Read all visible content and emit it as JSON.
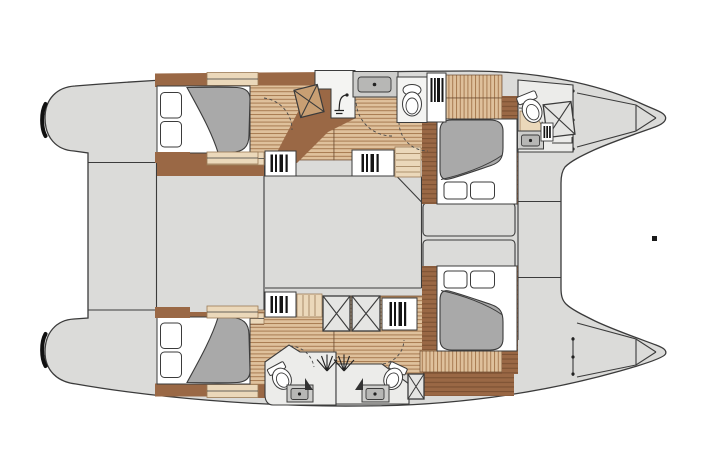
{
  "diagram": {
    "title": "Catamaran interior layout — overhead accommodation plan",
    "type": "boat-floorplan",
    "view": "top-down, bow to the right",
    "canvas": {
      "width": 705,
      "height": 470
    }
  },
  "colors": {
    "deck": "#DBDBD9",
    "outline": "#3B3B3B",
    "floor_light": "#DFC19C",
    "floor_seam": "#A87B52",
    "wood_dark": "#9A6845",
    "wood_seam": "#7C5133",
    "steps_light": "#EBD8BA",
    "steps_seam": "#C8A277",
    "mattress": "#A9A9A9",
    "counter": "#CDCDCB",
    "basin": "#B7B7B5",
    "pan": "#E5E5E3",
    "bath_floor": "#ECECEA",
    "white": "#FFFFFF",
    "bar": "#151515",
    "speck": "#1A1A1A",
    "seat_wood": "#C89F73"
  },
  "components": {
    "hulls": [
      "port hull (top)",
      "starboard hull (bottom)"
    ],
    "zones": [
      "twin stern transom platforms",
      "aft cockpit deck",
      "central saloon (two sections)",
      "forward deck with twin sunpads",
      "bow trampoline gap",
      "forepeak lockers in each bow"
    ],
    "port_hull": [
      "aft double cabin with berth and two pillows",
      "companionway with wooden steps",
      "shower compartment with shower-head symbol",
      "vanity counter with sink",
      "toilet compartment",
      "hanging lockers",
      "forward double cabin with island berth and two pillows",
      "forward ensuite head: tilted toilet, X shower pan, sink, small locker"
    ],
    "starboard_hull": [
      "aft double cabin with berth and two pillows",
      "wooden companionway steps",
      "two X shower pans plus one small X pan",
      "hanging lockers",
      "twin back-to-back heads each with tilted toilet, sink and shower spray",
      "forward double cabin with island berth and two pillows",
      "forepeak storage"
    ],
    "fixture_counts": {
      "double_berths": 4,
      "pillows": 8,
      "toilets": 4,
      "sinks": 4,
      "shower_pans": 4,
      "hanging_lockers": 6,
      "sunpads": 2
    }
  }
}
